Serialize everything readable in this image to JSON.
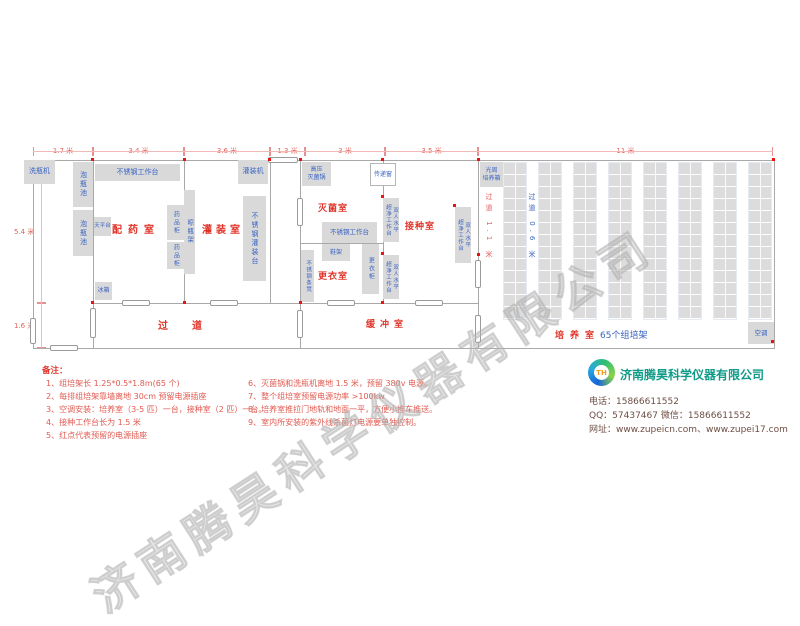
{
  "watermark": "济南腾昊科学仪器有限公司",
  "dims": {
    "top": [
      "1.7 米",
      "3.4 米",
      "3.6 米",
      "1.3 米",
      "3 米",
      "3.5 米",
      "11 米"
    ],
    "left": [
      "5.4 米",
      "1.6 米"
    ]
  },
  "rooms": {
    "peiyao": "配药室",
    "guanzhuang": "灌装室",
    "miejun": "灭菌室",
    "jiezhong": "接种室",
    "gengyi": "更衣室",
    "guodao": "过道",
    "huanchong": "缓冲室",
    "peiyang": "培养室",
    "peiyang_sub": "65个组培架"
  },
  "aisles": {
    "a1": "过道 1.1 米",
    "a2": "过道 0.6 米"
  },
  "equipment": {
    "xipingji": "洗瓶机",
    "paopingchi": "泡瓶池",
    "buxiugang_gongzuotai": "不锈钢工作台",
    "tianpingtai": "天平台",
    "yaopingui": "药品柜",
    "liangpingjia": "晾瓶架",
    "bingxiang": "冰箱",
    "guanzhuangtai": "不锈钢灌装台",
    "guanzhuangji": "灌装机",
    "gaoya_miejunguo": "高压\n灭菌锅",
    "chuandichuang": "传递窗",
    "chaojing_gongzuotai": "双人水平\n超净工作台",
    "xiejia": "鞋架",
    "gengyigui": "更衣柜",
    "tiaodeng": "不锈钢条凳",
    "guangzhou_peiyangxiang": "光周\n培养箱",
    "kongtiao": "空调"
  },
  "notes": {
    "title": "备注：",
    "left": [
      "1、组培架长 1.25*0.5*1.8m(65 个)",
      "2、每排组培架靠墙离地 30cm 预留电源插座",
      "3、空调安装：培养室（3-5 匹）一台，接种室（2 匹）一台。",
      "4、接种工作台长为 1.5 米",
      "5、红点代表预留的电源插座"
    ],
    "right": [
      "6、灭菌锅和洗瓶机离地 1.5 米，预留 380v 电源。",
      "7、整个组培室预留电源功率 >100kw",
      "8、培养室推拉门地轨和地面一平，方便小推车推送。",
      "9、室内所安装的紫外线杀菌灯电源要单独控制。"
    ]
  },
  "company": {
    "logo_text": "TH",
    "name": "济南腾昊科学仪器有限公司",
    "phone": "电话：15866611552",
    "qq_wechat": "QQ：57437467    微信：15866611552",
    "website": "网址：www.zupeicn.com、www.zupei17.com"
  }
}
